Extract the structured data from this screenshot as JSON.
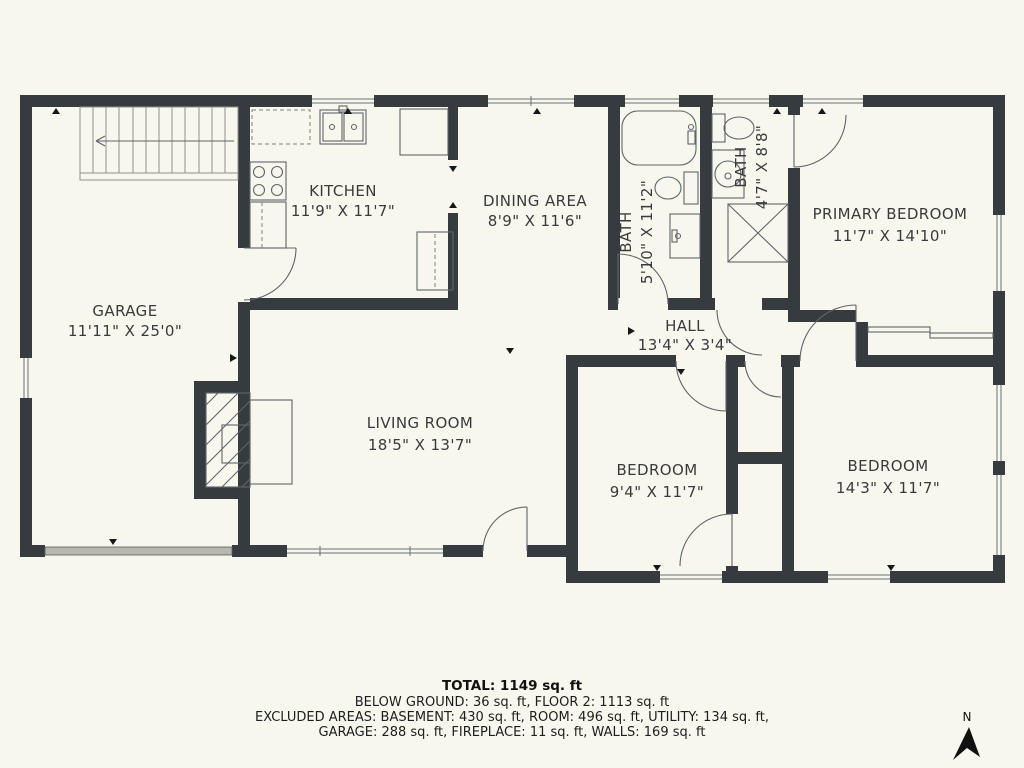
{
  "floorplan": {
    "rooms": [
      {
        "id": "garage",
        "name": "GARAGE",
        "dims": "11'11\" X 25'0\""
      },
      {
        "id": "kitchen",
        "name": "KITCHEN",
        "dims": "11'9\" X 11'7\""
      },
      {
        "id": "dining",
        "name": "DINING AREA",
        "dims": "8'9\" X 11'6\""
      },
      {
        "id": "bath1",
        "name": "BATH",
        "dims": "5'10\" X 11'2\""
      },
      {
        "id": "bath2",
        "name": "BATH",
        "dims": "4'7\" X 8'8\""
      },
      {
        "id": "primary",
        "name": "PRIMARY BEDROOM",
        "dims": "11'7\" X 14'10\""
      },
      {
        "id": "hall",
        "name": "HALL",
        "dims": "13'4\" X 3'4\""
      },
      {
        "id": "living",
        "name": "LIVING ROOM",
        "dims": "18'5\" X 13'7\""
      },
      {
        "id": "bedroom1",
        "name": "BEDROOM",
        "dims": "9'4\" X 11'7\""
      },
      {
        "id": "bedroom2",
        "name": "BEDROOM",
        "dims": "14'3\" X 11'7\""
      }
    ],
    "summary": {
      "total": "TOTAL: 1149 sq. ft",
      "line2": "BELOW GROUND: 36 sq. ft, FLOOR 2: 1113 sq. ft",
      "line3": "EXCLUDED AREAS: BASEMENT: 430 sq. ft, ROOM: 496 sq. ft, UTILITY: 134 sq. ft,",
      "line4": "GARAGE: 288 sq. ft, FIREPLACE: 11 sq. ft, WALLS: 169 sq. ft"
    },
    "compass": {
      "label": "N"
    },
    "colors": {
      "wall": "#363b40",
      "background": "#f8f7ee",
      "fixture_line": "#5f646a",
      "garage_door": "#b7b7ae",
      "text": "#383b3e"
    }
  }
}
